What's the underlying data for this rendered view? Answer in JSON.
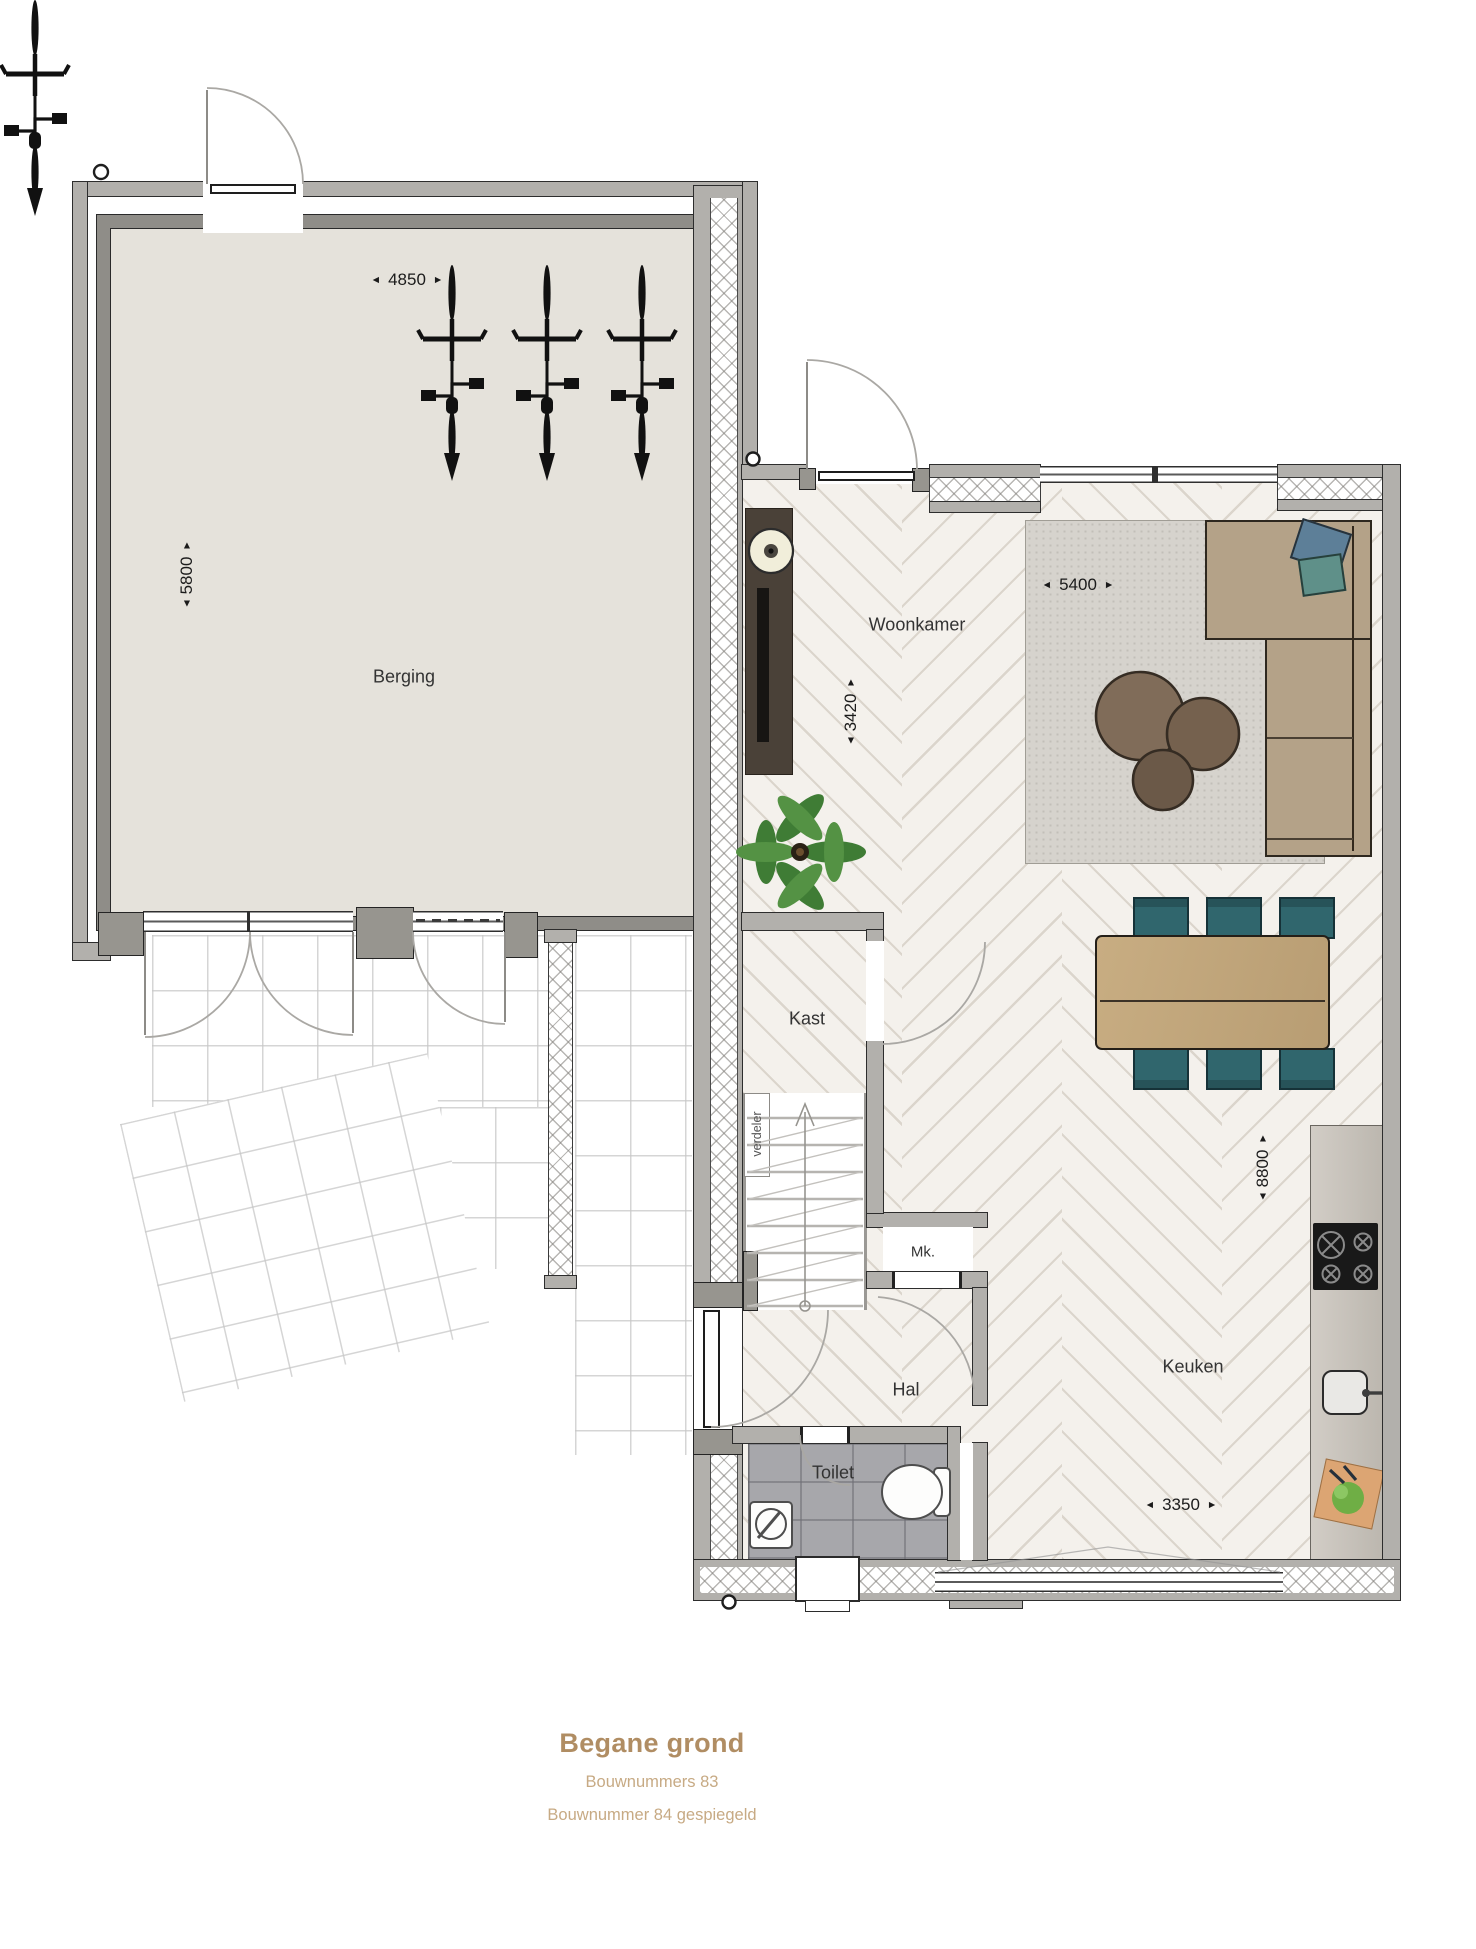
{
  "plan": {
    "rooms": {
      "berging": "Berging",
      "woonkamer": "Woonkamer",
      "kast": "Kast",
      "verdeler": "verdeler",
      "mk": "Mk.",
      "hal": "Hal",
      "toilet": "Toilet",
      "keuken": "Keuken"
    },
    "dimensions": {
      "berging_width": "4850",
      "berging_depth": "5800",
      "woonkamer_width": "5400",
      "woonkamer_depth": "3420",
      "house_depth": "8800",
      "keuken_width": "3350"
    },
    "icons": {
      "arrow_left": "◄",
      "arrow_right": "►",
      "arrow_up": "▲",
      "arrow_down": "▼"
    }
  },
  "title": {
    "heading": "Begane grond",
    "subtitle1": "Bouwnummers 83",
    "subtitle2": "Bouwnummer 84 gespiegeld",
    "accent_color": "#b08d63",
    "subtitle_color": "#c7aa84"
  }
}
